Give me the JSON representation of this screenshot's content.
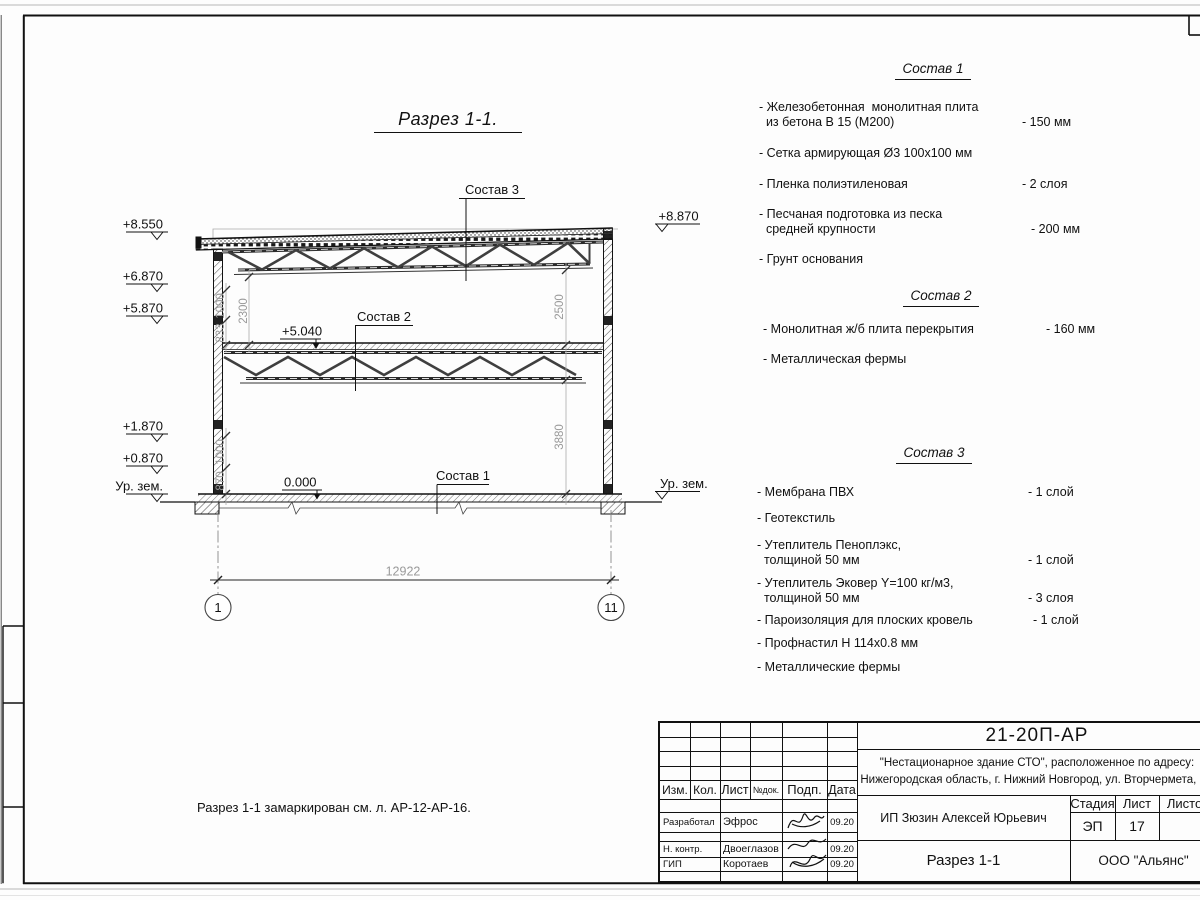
{
  "section": {
    "title": "Разрез 1-1.",
    "marks": {
      "roof_right": "+8.870",
      "floor2": "+5.040",
      "zero": "0.000",
      "ground_right": "Ур. зем."
    },
    "elevations_left": [
      "+8.550",
      "+6.870",
      "+5.870",
      "+1.870",
      "+0.870",
      "Ур. зем."
    ],
    "dims": {
      "total": "12922",
      "left_lower": [
        "870",
        "1000"
      ],
      "left_upper": [
        "833",
        "1000"
      ],
      "inner": "2300",
      "right": [
        "2500",
        "3880"
      ]
    },
    "grid": {
      "left": "1",
      "right": "11"
    }
  },
  "comp1": {
    "title": "Состав 1",
    "items": [
      {
        "text": "- Железобетонная  монолитная плита\n  из бетона В 15 (М200)",
        "value": "- 150 мм"
      },
      {
        "text": "- Сетка армирующая Ø3 100x100 мм",
        "value": ""
      },
      {
        "text": "- Пленка полиэтиленовая",
        "value": "-  2 слоя"
      },
      {
        "text": "- Песчаная подготовка из песка\n  средней крупности",
        "value": "- 200 мм"
      },
      {
        "text": "- Грунт основания",
        "value": ""
      }
    ]
  },
  "comp2": {
    "title": "Состав 2",
    "items": [
      {
        "text": "- Монолитная ж/б плита перекрытия",
        "value": "- 160 мм"
      },
      {
        "text": "- Металлическая фермы",
        "value": ""
      }
    ]
  },
  "comp3": {
    "title": "Состав 3",
    "items": [
      {
        "text": "- Мембрана ПВХ",
        "value": "- 1 слой"
      },
      {
        "text": "- Геотекстиль",
        "value": "- 1 слой"
      },
      {
        "text": "- Утеплитель Пеноплэкс,\n  толщиной 50 мм",
        "value": "- 1 слой"
      },
      {
        "text": "- Утеплитель Эковер Y=100 кг/м3,\n  толщиной 50 мм",
        "value": "- 3 слоя"
      },
      {
        "text": "- Пароизоляция для плоских кровель",
        "value": "- 1 слой"
      },
      {
        "text": "- Профнастил Н 114x0.8 мм",
        "value": ""
      },
      {
        "text": "- Металлические фермы",
        "value": ""
      }
    ]
  },
  "note": {
    "text": "Разрез 1-1 замаркирован см. л. АР-12-АР-16."
  },
  "titleblock": {
    "doc_number": "21-20П-АР",
    "project_line1": "\"Нестационарное здание СТО\", расположенное по адресу:",
    "project_line2": "Нижегородская область, г. Нижний Новгород, ул. Вторчермета, 1А",
    "client": "ИП Зюзин Алексей Юрьевич",
    "stage_label": "Стадия",
    "sheet_label": "Лист",
    "sheets_label": "Листов",
    "stage": "ЭП",
    "sheet": "17",
    "sheet_title": "Разрез 1-1",
    "company": "ООО \"Альянс\"",
    "cols": {
      "izm": "Изм.",
      "kol": "Кол.",
      "list": "Лист",
      "ndok": "№док.",
      "podp": "Подп.",
      "data": "Дата"
    },
    "rows": [
      {
        "role": "Разработал",
        "name": "Эфрос",
        "date": "09.20"
      },
      {
        "role": "Н. контр.",
        "name": "Двоеглазов",
        "date": "09.20"
      },
      {
        "role": "ГИП",
        "name": "Коротаев",
        "date": "09.20"
      }
    ]
  }
}
